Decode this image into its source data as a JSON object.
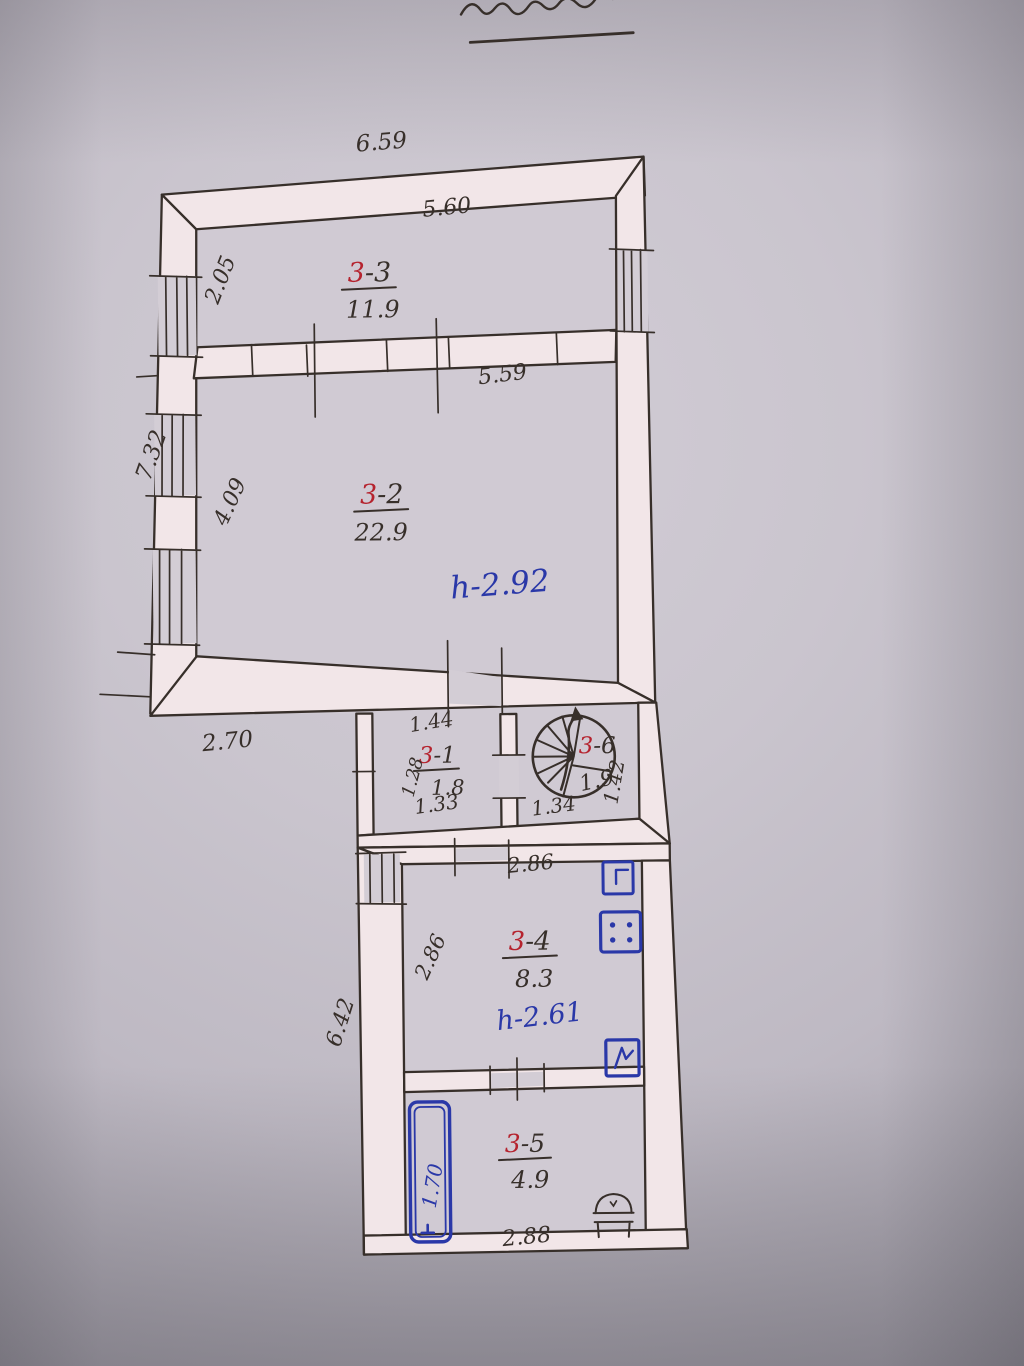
{
  "palette": {
    "ink": "#372f2a",
    "red": "#b5232e",
    "blue": "#2a38a8",
    "paper": "#c9c4cd",
    "wall_fill": "#f2e6e8"
  },
  "rooms": [
    {
      "prefix": "3",
      "suffix": "-3",
      "area": "11.9"
    },
    {
      "prefix": "3",
      "suffix": "-2",
      "area": "22.9",
      "height_note": "h-2.92"
    },
    {
      "prefix": "3",
      "suffix": "-1",
      "area": "1.8"
    },
    {
      "prefix": "3",
      "suffix": "-6",
      "area": "1.9"
    },
    {
      "prefix": "3",
      "suffix": "-4",
      "area": "8.3",
      "height_note": "h-2.61"
    },
    {
      "prefix": "3",
      "suffix": "-5",
      "area": "4.9"
    }
  ],
  "dimensions": {
    "upper_outer_width": "6.59",
    "room33_inner_width": "5.60",
    "room33_depth": "2.05",
    "left_side_total": "7.32",
    "room32_depth": "4.09",
    "room32_inner_width": "5.59",
    "lower_left_offset": "2.70",
    "room31_top_width": "1.44",
    "room31_depth": "1.28",
    "room31_bottom_width": "1.33",
    "stair_room_width": "1.34",
    "stair_room_depth": "1.42",
    "room34_top_width": "2.86",
    "room34_depth": "2.86",
    "lower_block_left_height": "6.42",
    "bath_length": "1.70",
    "room35_bottom_width": "2.88"
  },
  "icons": {
    "spiral-staircase-icon": "circle with radial treads and direction arrow",
    "window-icon": "double line in wall band",
    "sink-icon": "blue square with tap",
    "stove-icon": "blue square with four burner dots",
    "water-heater-icon": "blue square with glyph",
    "bath-icon": "blue double rounded rectangle",
    "toilet-icon": "dome-top cistern outline"
  }
}
